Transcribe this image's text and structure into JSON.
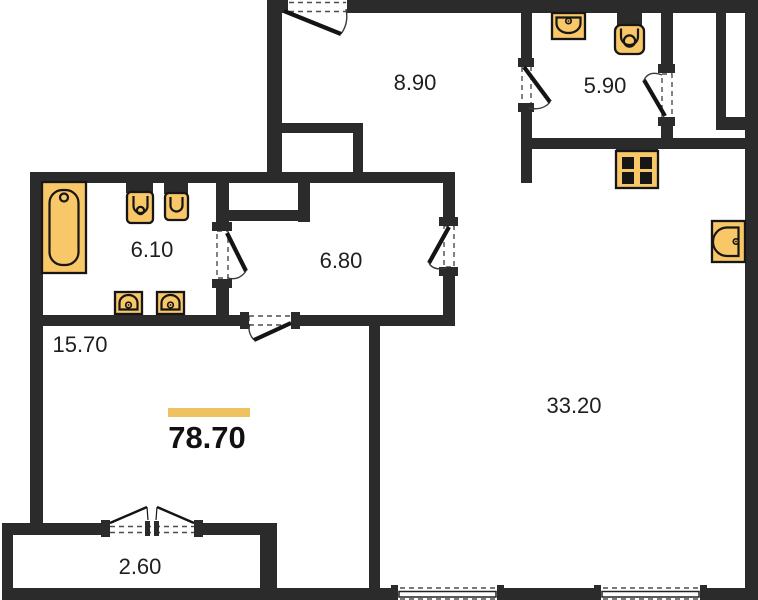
{
  "floorplan": {
    "total_area": "78.70",
    "rooms": {
      "entrance_hall": {
        "area": "8.90"
      },
      "bathroom": {
        "area": "5.90"
      },
      "bathroom_2": {
        "area": "6.10"
      },
      "corridor": {
        "area": "6.80"
      },
      "bedroom": {
        "area": "15.70"
      },
      "living_kitchen": {
        "area": "33.20"
      },
      "balcony": {
        "area": "2.60"
      }
    },
    "fixtures": [
      "bathtub",
      "wall-toilet",
      "bidet",
      "washbasin",
      "washbasin",
      "sink",
      "toilet",
      "stove",
      "kitchen-sink"
    ],
    "colors": {
      "wall": "#2b2b2b",
      "fixture_fill": "#f8c768",
      "fixture_stroke": "#161616",
      "accent_bar": "#eec161",
      "background": "#ffffff",
      "label_text": "#1f1f1f"
    }
  }
}
